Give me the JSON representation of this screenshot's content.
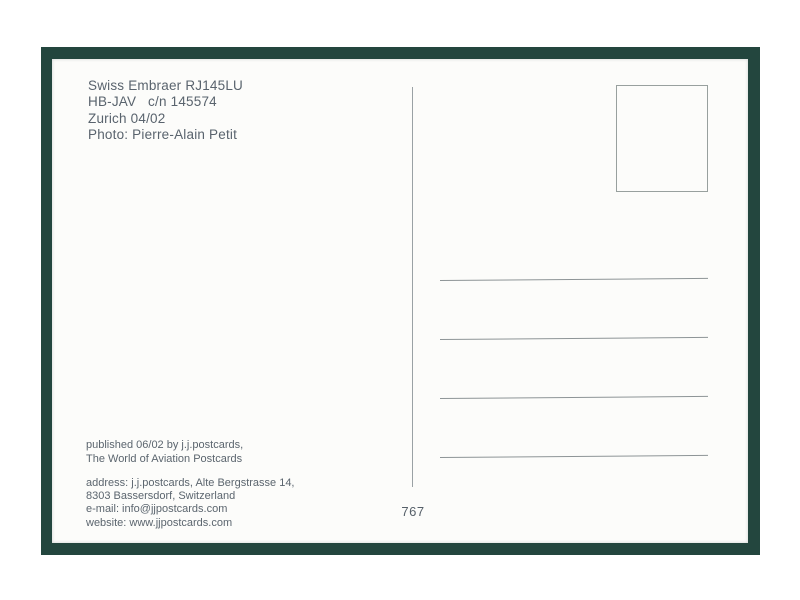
{
  "scan": {
    "frame_color": "#23463e",
    "card_color": "#fcfcfa",
    "text_color": "#59636d",
    "line_color": "#8d9496"
  },
  "postcard": {
    "caption": {
      "lines": [
        "Swiss Embraer RJ145LU",
        "HB-JAV   c/n 145574",
        "Zurich 04/02",
        "Photo: Pierre-Alain Petit"
      ]
    },
    "publisher": {
      "lines": [
        "published 06/02 by j.j.postcards,",
        "The World of Aviation Postcards"
      ]
    },
    "contact": {
      "lines": [
        "address: j.j.postcards, Alte Bergstrasse 14,",
        "8303 Bassersdorf, Switzerland",
        "e-mail: info@jjpostcards.com",
        "website: www.jjpostcards.com"
      ]
    },
    "card_number": "767",
    "address_ruling_lines": 4
  }
}
